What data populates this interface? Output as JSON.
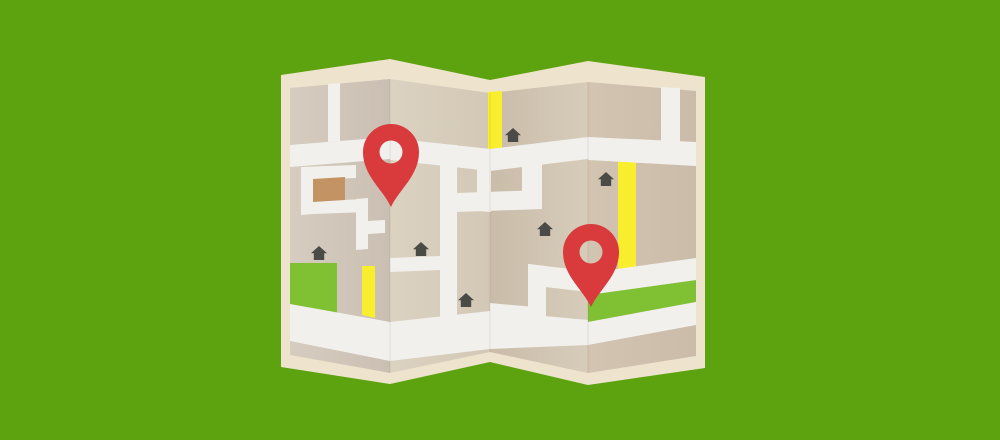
{
  "background_color": "#5ca30f",
  "map": {
    "kind": "folded-paper-map-illustration",
    "border_color": "#eee3cd",
    "road_color": "#f1f0ed",
    "yellow_road_color": "#f9ee2d",
    "park_color": "#80c133",
    "building_color": "#c39363",
    "house_color": "#4a4a47",
    "pin_color": "#d93a3c",
    "fold_shade_color": "rgba(0,0,0,0.05)",
    "panel_colors": {
      "p1_left": "#d6ccbf",
      "p1_right": "#cabfb2",
      "p2_left": "#dcd2c1",
      "p2_right": "#d3c8b6",
      "p3_left": "#c9bca9",
      "p3_right": "#d7ccba",
      "p4_left": "#d2c4b0",
      "p4_right": "#cabca8"
    },
    "pins": [
      {
        "x": 391,
        "y": 152
      },
      {
        "x": 591,
        "y": 252
      }
    ],
    "houses": [
      {
        "x": 311,
        "y": 246
      },
      {
        "x": 413,
        "y": 242
      },
      {
        "x": 458,
        "y": 293
      },
      {
        "x": 505,
        "y": 128
      },
      {
        "x": 537,
        "y": 222
      },
      {
        "x": 598,
        "y": 172
      }
    ],
    "counts": {
      "panels": 4,
      "pins": 2,
      "houses": 6,
      "yellow_roads": 3,
      "green_areas": 2,
      "buildings": 1
    }
  }
}
